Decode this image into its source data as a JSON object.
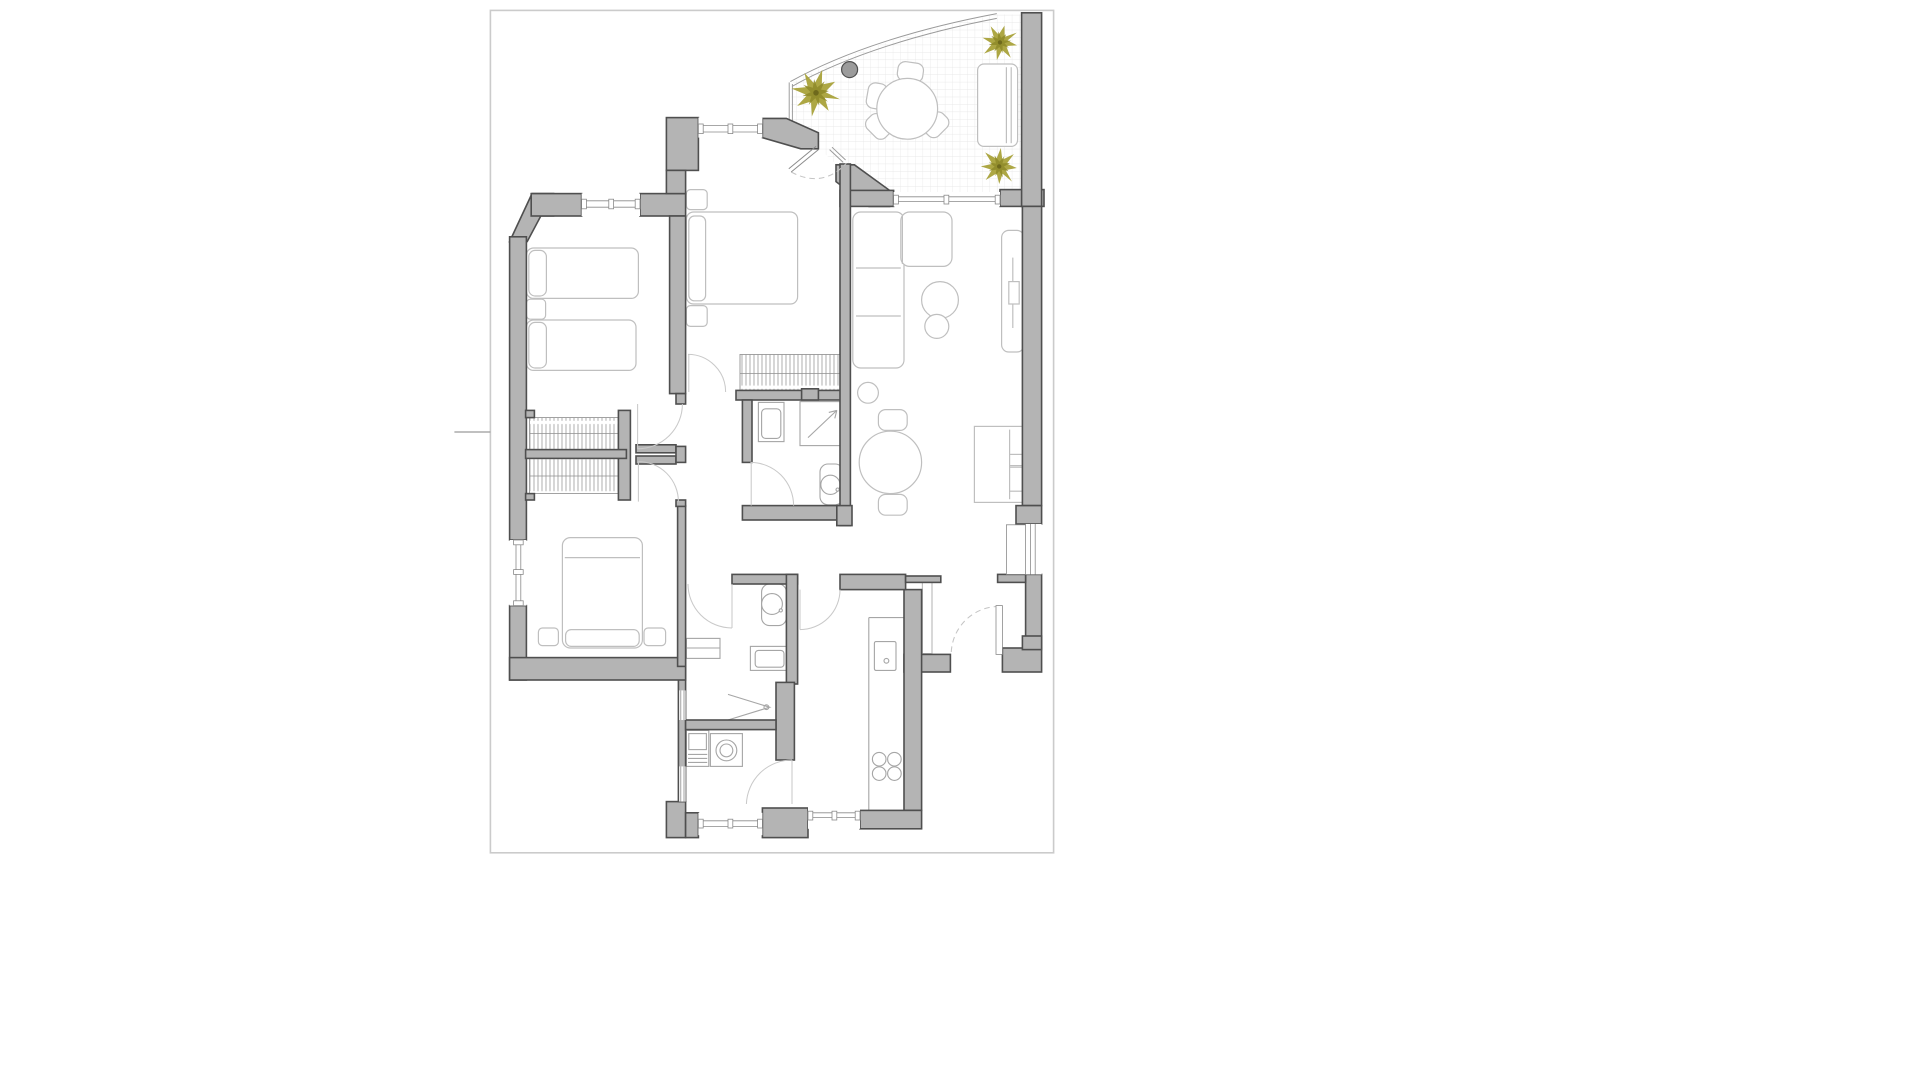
{
  "document": {
    "kind": "apartment floor plan drawing",
    "page": {
      "background": "#ffffff",
      "border_color": "#cbcbcb"
    }
  },
  "colors": {
    "canvas_bg": "#ffffff",
    "page_bg": "#ffffff",
    "page_border": "#cbcbcb",
    "wall_fill": "#b4b4b4",
    "wall_stroke": "#4f4f4f",
    "furniture_stroke": "#bfbfbf",
    "furniture_fill": "#ffffff",
    "fixture_stroke": "#a6a6a6",
    "hatch_line": "#8f8f8f",
    "door_arc": "#c9c9c9",
    "dashed_arc": "#c4c4c4",
    "window_line": "#8a8a8a",
    "grid_line": "#e3e3e3",
    "rail_line": "#9a9a9a",
    "tick_line": "#9a9a9a",
    "palm_primary": "#a9a23a",
    "palm_secondary": "#8e8929",
    "palm_center": "#6e691c",
    "planter_fill": "#9b9b9b",
    "planter_stroke": "#4f4f4f"
  },
  "inventory": {
    "rooms": [
      {
        "name": "bedroom-top-left",
        "furniture": [
          "single-bed",
          "single-bed",
          "nightstand",
          "built-in-wardrobe"
        ],
        "windows": 1
      },
      {
        "name": "bedroom-top-middle",
        "furniture": [
          "double-bed",
          "nightstand",
          "nightstand",
          "built-in-wardrobe"
        ],
        "windows": 1,
        "terrace_access": true
      },
      {
        "name": "bedroom-bottom-left",
        "furniture": [
          "double-bed",
          "nightstand",
          "nightstand",
          "wardrobe"
        ],
        "windows": 1
      },
      {
        "name": "living-dining-room",
        "furniture": [
          "corner-sofa",
          "coffee-table",
          "side-table",
          "pouf",
          "round-dining-table",
          "dining-chair",
          "dining-chair",
          "sideboard",
          "desk-cabinet"
        ],
        "windows": 2
      },
      {
        "name": "bathroom-middle",
        "furniture": [
          "washbasin",
          "shower",
          "toilet"
        ]
      },
      {
        "name": "bathroom-bottom",
        "furniture": [
          "toilet",
          "washbasin",
          "cabinet",
          "shower-screen"
        ]
      },
      {
        "name": "laundry",
        "furniture": [
          "sink-unit",
          "washing-machine"
        ],
        "windows": 1
      },
      {
        "name": "kitchen",
        "furniture": [
          "counter",
          "sink",
          "hob"
        ],
        "windows": 1
      },
      {
        "name": "hallway",
        "furniture": [
          "tall-unit"
        ]
      },
      {
        "name": "terrace",
        "floor": "tile-grid",
        "furniture": [
          "round-table",
          "chair",
          "chair",
          "chair",
          "chair",
          "bench-lounger",
          "planter"
        ]
      }
    ],
    "counts": {
      "palm_plants": 3,
      "hob_burners": 4,
      "door_swings": 9,
      "wardrobe_hatched_units": 4
    }
  }
}
